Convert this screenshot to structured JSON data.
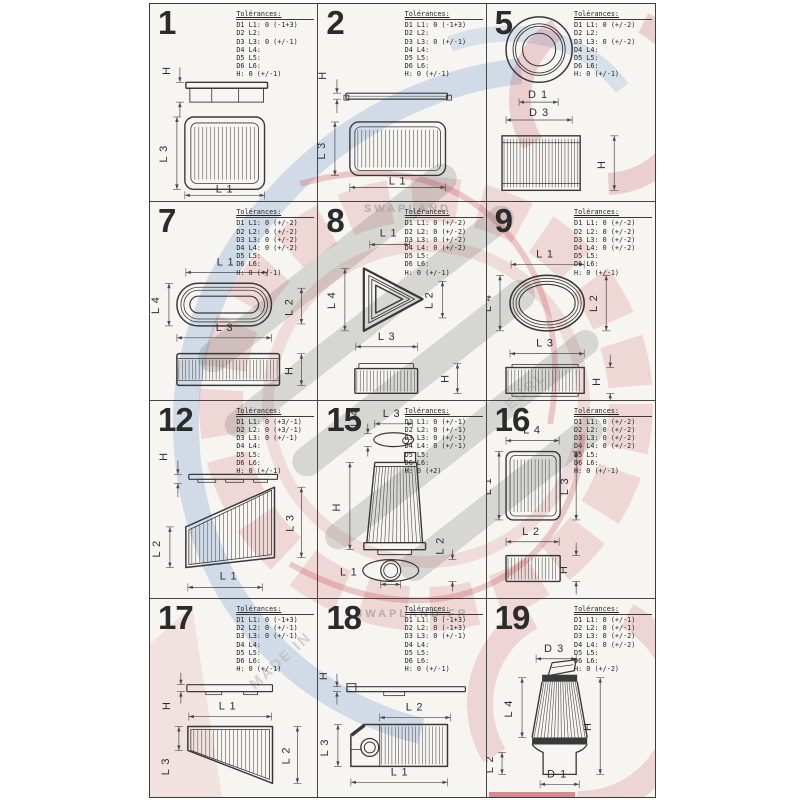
{
  "page": {
    "background": "#ffffff",
    "sheet_background": "#f6f5f2",
    "line_color": "#3c3c3c",
    "accent_red": "#be232d",
    "accent_blue": "#6e96cd"
  },
  "tolerance_header": "Tolérances:",
  "watermark": {
    "brand_top": "SWAPLAND",
    "brand_bottom": "SWAPLAND.FR",
    "diagonal_left": "MADE IN",
    "diagonal_right": "EURL"
  },
  "cells": [
    {
      "number": "1",
      "shape": "rectangular-panel",
      "tolerances": [
        "D1 L1: 0 (-1+3)",
        "D2 L2:",
        "D3 L3: 0 (+/-1)",
        "D4 L4:",
        "D5 L5:",
        "D6 L6:",
        "H: 0 (+/-1)"
      ],
      "dims": [
        "H",
        "L 3",
        "L 1"
      ]
    },
    {
      "number": "2",
      "shape": "flat-rectangular-panel",
      "tolerances": [
        "D1 L1: 0 (-1+3)",
        "D2 L2:",
        "D3 L3: 0 (+/-1)",
        "D4 L4:",
        "D5 L5:",
        "D6 L6:",
        "H: 0 (+/-1)"
      ],
      "dims": [
        "H",
        "L 3",
        "L 1"
      ]
    },
    {
      "number": "5",
      "shape": "round-cylinder",
      "tolerances": [
        "D1 L1: 0 (+/-2)",
        "D2 L2:",
        "D3 L3: 0 (+/-2)",
        "D4 L4:",
        "D5 L5:",
        "D6 L6:",
        "H: 0 (+/-1)"
      ],
      "dims": [
        "D 1",
        "D 3",
        "H"
      ]
    },
    {
      "number": "7",
      "shape": "oblong",
      "tolerances": [
        "D1 L1: 0 (+/-2)",
        "D2 L2: 0 (+/-2)",
        "D3 L3: 0 (+/-2)",
        "D4 L4: 0 (+/-2)",
        "D5 L5:",
        "D6 L6:",
        "H: 0 (+/-1)"
      ],
      "dims": [
        "L 1",
        "L 4",
        "L 3",
        "L 2",
        "H"
      ]
    },
    {
      "number": "8",
      "shape": "triangular",
      "tolerances": [
        "D1 L1: 0 (+/-2)",
        "D2 L2: 0 (+/-2)",
        "D3 L3: 0 (+/-2)",
        "D4 L4: 0 (+/-2)",
        "D5 L5:",
        "D6 L6:",
        "H: 0 (+/-1)"
      ],
      "dims": [
        "L 1",
        "L 4",
        "L 2",
        "L 3",
        "H"
      ]
    },
    {
      "number": "9",
      "shape": "oval",
      "tolerances": [
        "D1 L1: 0 (+/-2)",
        "D2 L2: 0 (+/-2)",
        "D3 L3: 0 (+/-2)",
        "D4 L4: 0 (+/-2)",
        "D5 L5:",
        "D6 L6:",
        "H: 0 (+/-1)"
      ],
      "dims": [
        "L 1",
        "L 4",
        "L 2",
        "L 3",
        "H"
      ]
    },
    {
      "number": "12",
      "shape": "trapezoid-panel",
      "tolerances": [
        "D1 L1: 0 (+3/-1)",
        "D2 L2: 0 (+3/-1)",
        "D3 L3: 0 (+/-1)",
        "D4 L4:",
        "D5 L5:",
        "D6 L6:",
        "H: 0 (+/-1)"
      ],
      "dims": [
        "H",
        "L 2",
        "L 3",
        "L 1"
      ]
    },
    {
      "number": "15",
      "shape": "tapered-cone",
      "tolerances": [
        "D1 L1: 0 (+/-1)",
        "D2 L2: 0 (+/-1)",
        "D3 L3: 0 (+/-1)",
        "D4 L4: 0 (+/-1)",
        "D5 L5:",
        "D6 L6:",
        "H: 0 (+2)"
      ],
      "dims": [
        "L 4",
        "L 3",
        "H",
        "L 1",
        "L 2"
      ]
    },
    {
      "number": "16",
      "shape": "small-rectangular-panel",
      "tolerances": [
        "D1 L1: 0 (+/-2)",
        "D2 L2: 0 (+/-2)",
        "D3 L3: 0 (+/-2)",
        "D4 L4: 0 (+/-2)",
        "D5 L5:",
        "D6 L6:",
        "H: 0 (+/-1)"
      ],
      "dims": [
        "L 4",
        "L 1",
        "L 3",
        "L 2",
        "H"
      ]
    },
    {
      "number": "17",
      "shape": "wedge-panel",
      "tolerances": [
        "D1 L1: 0 (-1+3)",
        "D2 L2: 0 (+/-1)",
        "D3 L3: 0 (+/-1)",
        "D4 L4:",
        "D5 L5:",
        "D6 L6:",
        "H: 0 (+/-1)"
      ],
      "dims": [
        "H",
        "L 1",
        "L 3",
        "L 2"
      ]
    },
    {
      "number": "18",
      "shape": "notched-panel",
      "tolerances": [
        "D1 L1: 0 (-1+3)",
        "D2 L2: 0 (-1+3)",
        "D3 L3: 0 (+/-1)",
        "D4 L4:",
        "D5 L5:",
        "D6 L6:",
        "H: 0 (+/-1)"
      ],
      "dims": [
        "H",
        "L 2",
        "L 3",
        "L 1"
      ]
    },
    {
      "number": "19",
      "shape": "clamp-on-cone",
      "tolerances": [
        "D1 L1: 0 (+/-1)",
        "D2 L2: 0 (+/-1)",
        "D3 L3: 0 (+/-2)",
        "D4 L4: 0 (+/-2)",
        "D5 L5:",
        "D6 L6:",
        "H: 0 (+/-2)"
      ],
      "dims": [
        "D 3",
        "L 4",
        "H",
        "D 1",
        "L 2"
      ]
    }
  ]
}
